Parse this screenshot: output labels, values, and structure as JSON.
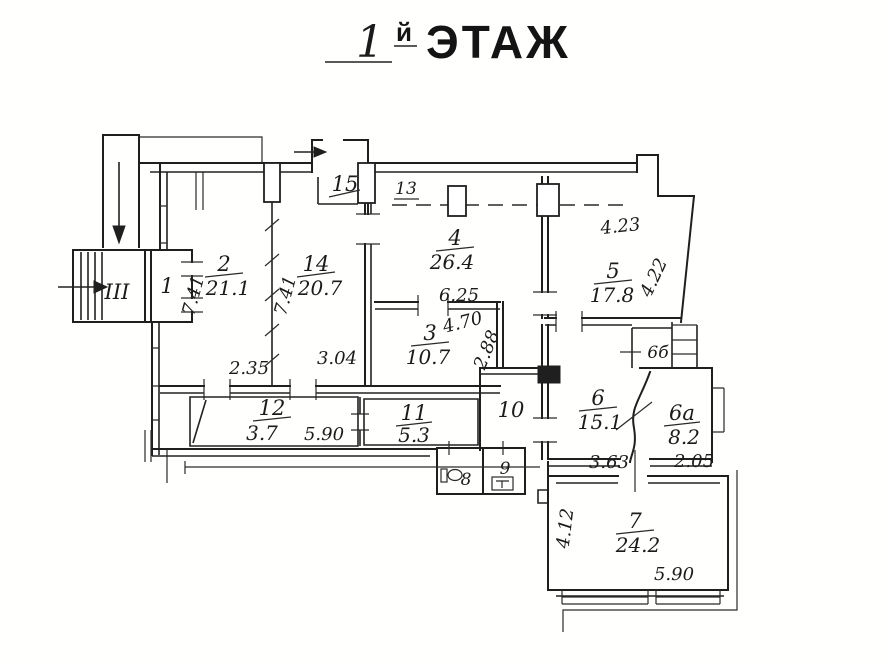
{
  "title": {
    "number": "1",
    "suffix": "й",
    "word": "ЭТАЖ"
  },
  "entrance": {
    "label": "III"
  },
  "rooms": {
    "r1": {
      "num": "1"
    },
    "r2": {
      "num": "2",
      "area": "21.1"
    },
    "r3": {
      "num": "3",
      "area": "10.7"
    },
    "r4": {
      "num": "4",
      "area": "26.4"
    },
    "r5": {
      "num": "5",
      "area": "17.8"
    },
    "r6": {
      "num": "6",
      "area": "15.1"
    },
    "r6a": {
      "num": "6а",
      "area": "8.2"
    },
    "r6b": {
      "num": "6б"
    },
    "r7": {
      "num": "7",
      "area": "24.2"
    },
    "r8": {
      "num": "8"
    },
    "r9": {
      "num": "9"
    },
    "r10": {
      "num": "10"
    },
    "r11": {
      "num": "11",
      "area": "5.3"
    },
    "r12": {
      "num": "12",
      "area": "3.7"
    },
    "r13": {
      "num": "13"
    },
    "r14": {
      "num": "14",
      "area": "20.7"
    },
    "r15": {
      "num": "15"
    }
  },
  "dimensions": {
    "room2_depth": "7.41",
    "room2_width": "2.35",
    "room14_depth": "7.41",
    "room14_width": "3.04",
    "room3_top": "6.25",
    "room3_width": "4.70",
    "room3_depth": "2.88",
    "room5_width": "4.23",
    "room5_depth": "4.22",
    "room6_width": "3.63",
    "room6a_width": "2.05",
    "room7_depth": "4.12",
    "room7_width": "5.90",
    "corridor_width": "5.90"
  },
  "colors": {
    "ink": "#1f1f1f",
    "paper": "#ffffff"
  }
}
